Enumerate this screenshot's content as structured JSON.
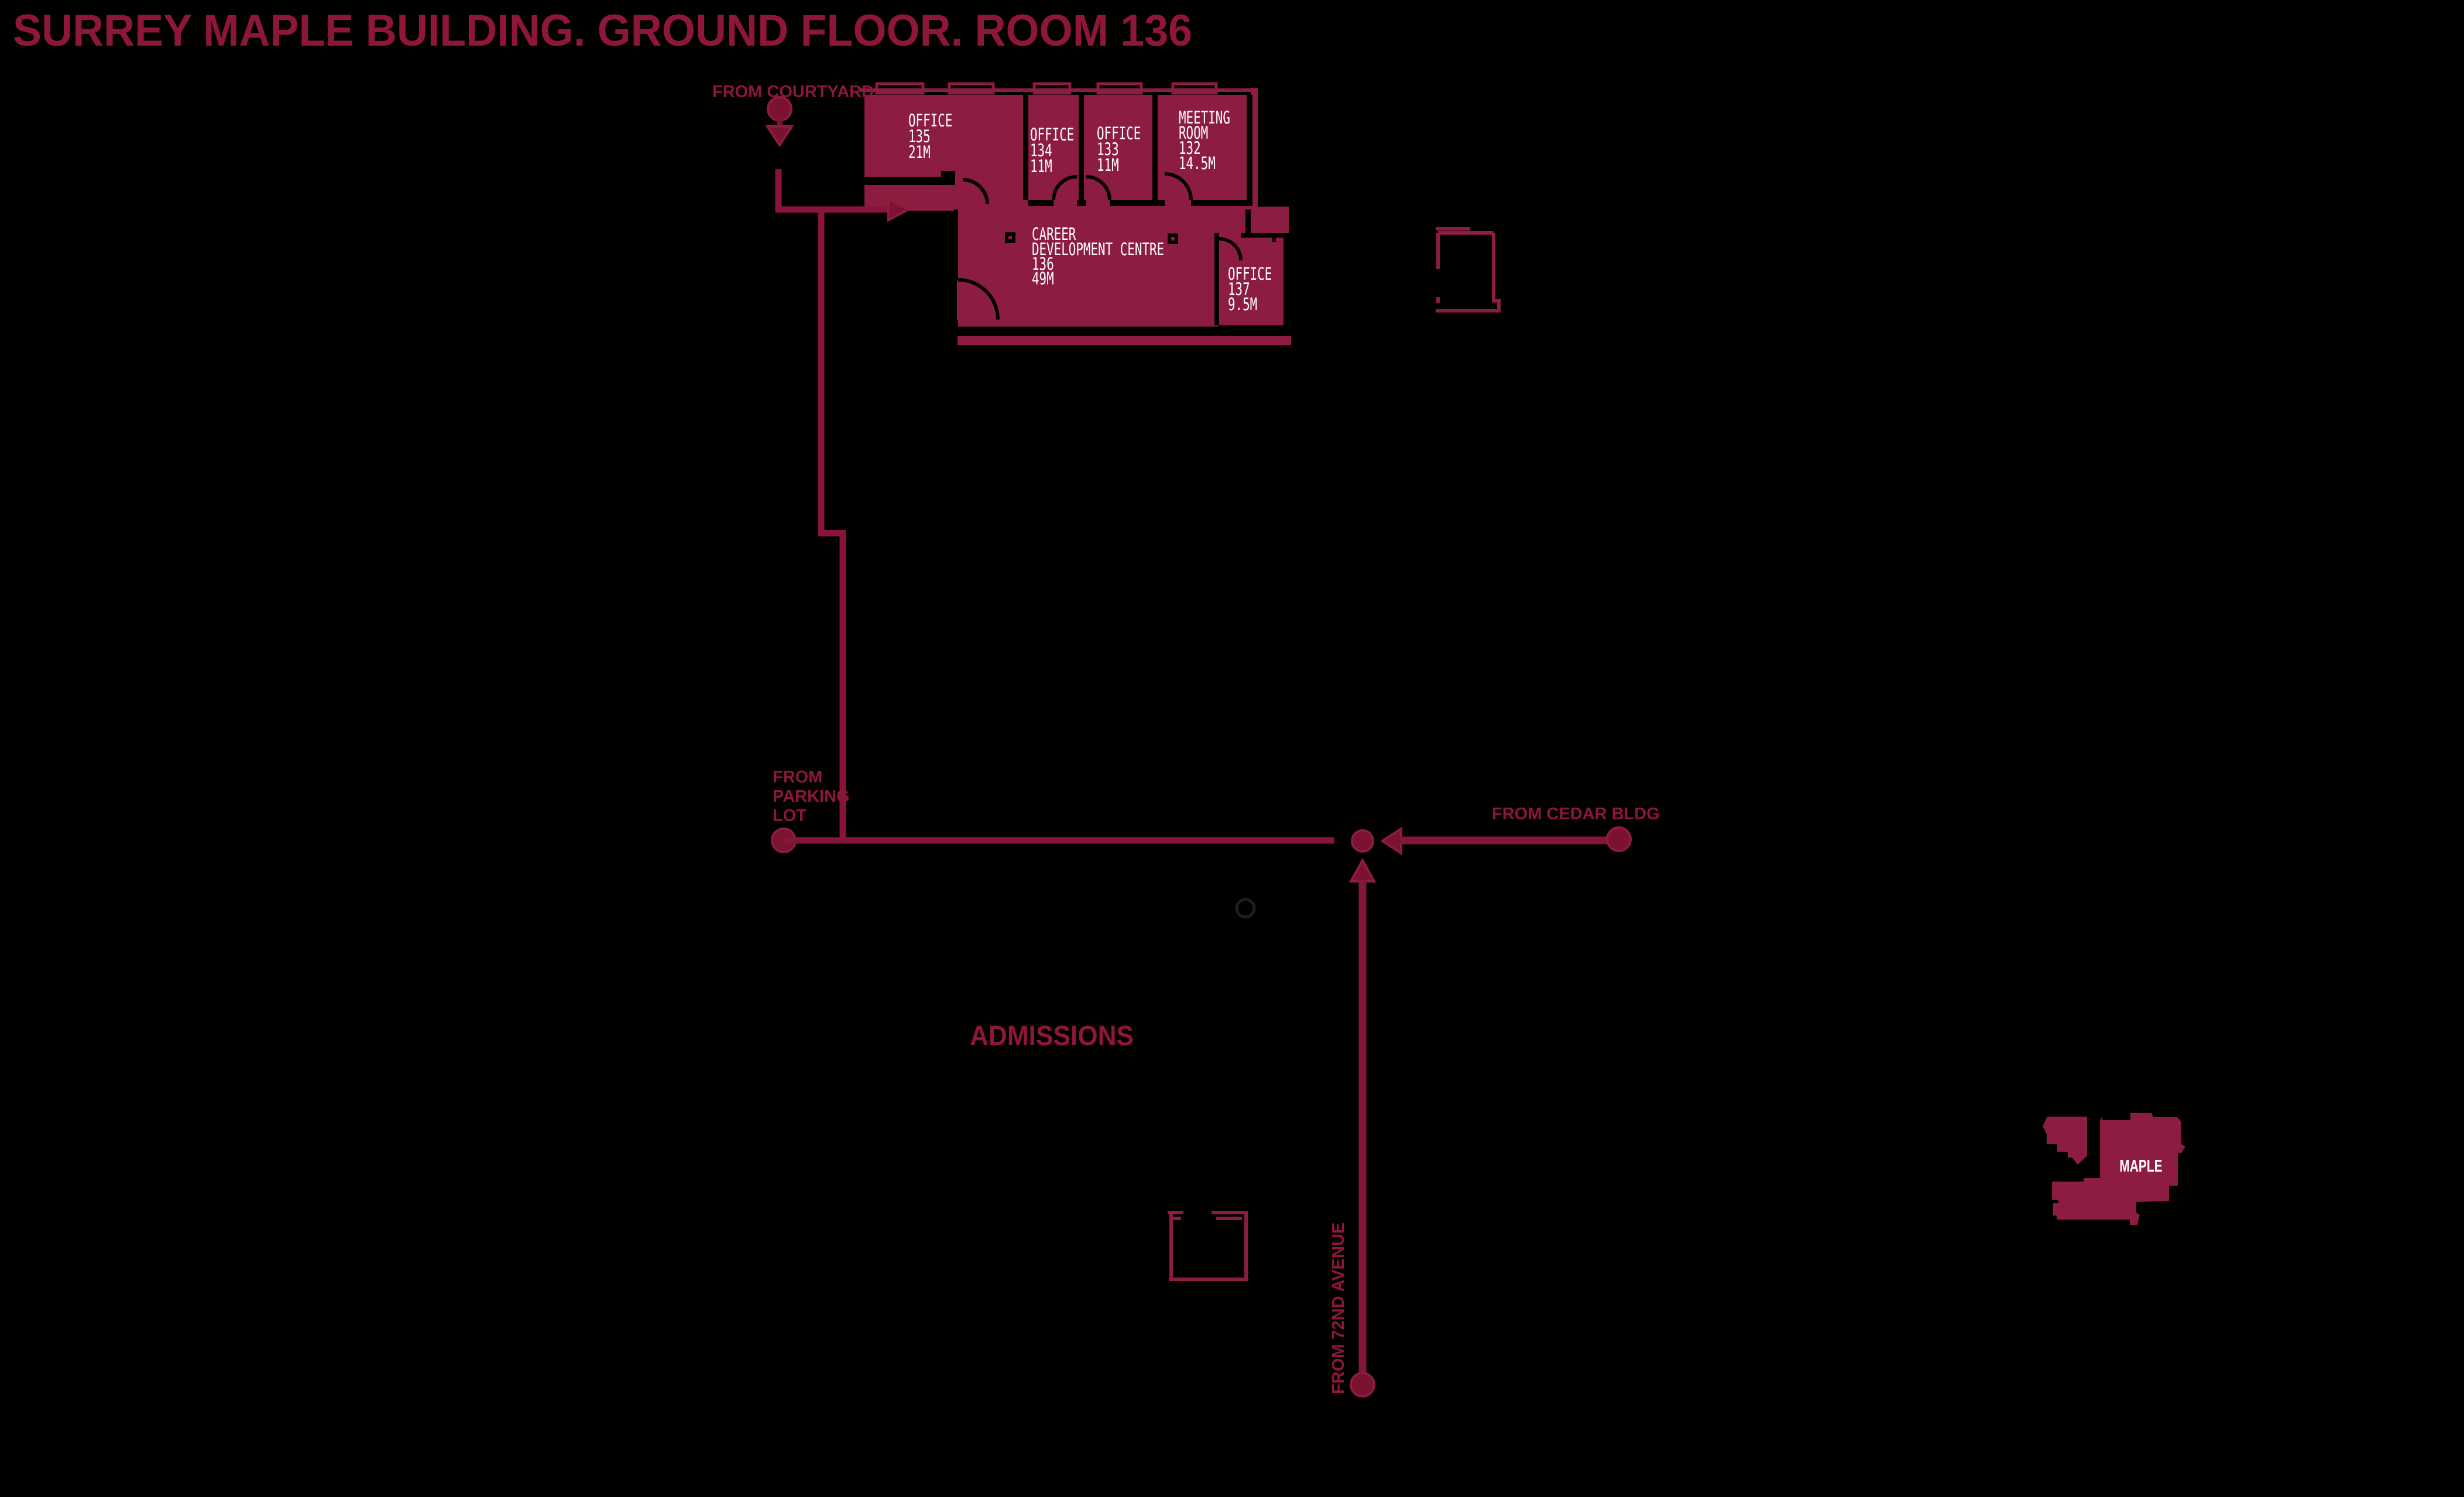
{
  "title": "SURREY MAPLE BUILDING. GROUND FLOOR. ROOM 136",
  "colors": {
    "background": "#000000",
    "room_fill": "#8C1D40",
    "room_label": "#FFFFFF",
    "heading": "#8E1638",
    "route_line": "#87153A",
    "route_marker": "#7A1230"
  },
  "rooms": {
    "office135": {
      "lines": [
        "OFFICE",
        "135",
        "21M"
      ]
    },
    "office134": {
      "lines": [
        "OFFICE",
        "134",
        "11M"
      ]
    },
    "office133": {
      "lines": [
        "OFFICE",
        "133",
        "11M"
      ]
    },
    "meeting132": {
      "lines": [
        "MEETING",
        "ROOM",
        "132",
        "14.5M"
      ]
    },
    "careerCentre136": {
      "lines": [
        "CAREER",
        "DEVELOPMENT CENTRE",
        "136",
        "49M"
      ]
    },
    "office137": {
      "lines": [
        "OFFICE",
        "137",
        "9.5M"
      ]
    }
  },
  "entries": {
    "courtyard": {
      "label": "FROM COURTYARD"
    },
    "parking": {
      "lines": [
        "FROM",
        "PARKING",
        "LOT"
      ]
    },
    "cedar": {
      "label": "FROM CEDAR BLDG"
    },
    "avenue72": {
      "label": "FROM 72ND AVENUE"
    }
  },
  "annotations": {
    "admissions": "ADMISSIONS"
  },
  "minimap": {
    "building_label": "MAPLE"
  }
}
